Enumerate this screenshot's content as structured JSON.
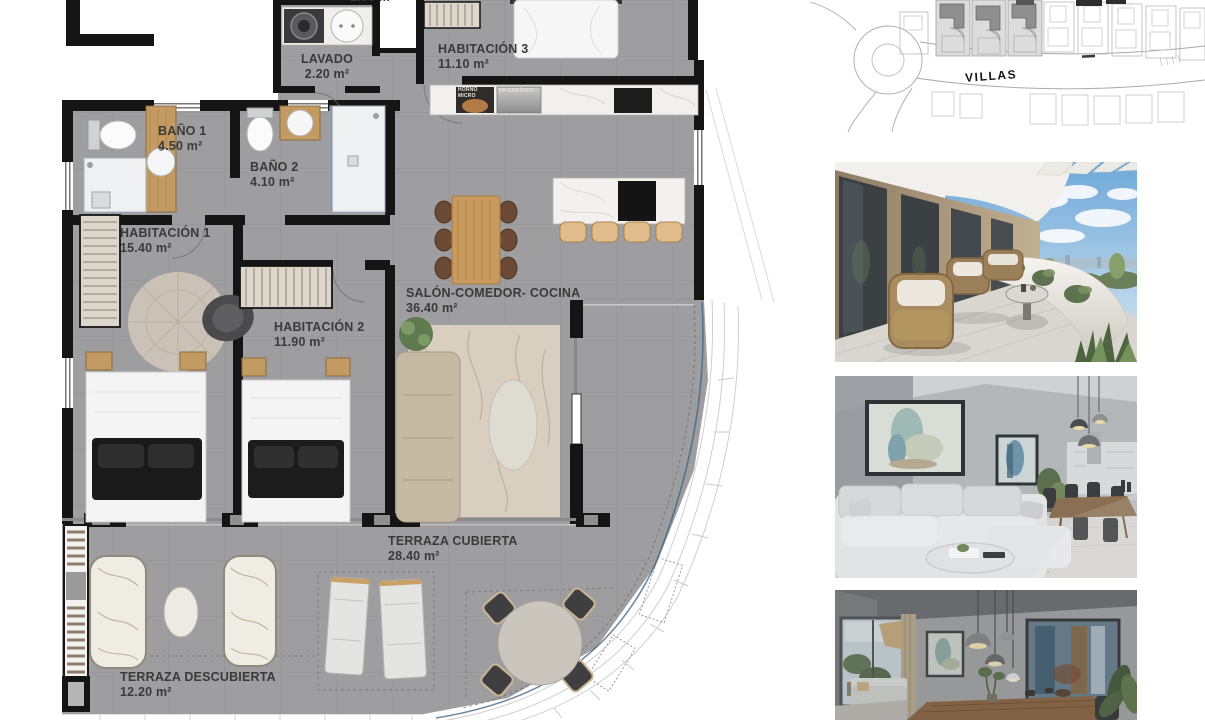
{
  "floor_plan": {
    "rooms": [
      {
        "id": "lavado",
        "name": "LAVADO",
        "area": "2.20 m²"
      },
      {
        "id": "habitacion3",
        "name": "HABITACIÓN 3",
        "area": "11.10 m²"
      },
      {
        "id": "bano1",
        "name": "BAÑO 1",
        "area": "4.50 m²"
      },
      {
        "id": "bano2",
        "name": "BAÑO 2",
        "area": "4.10 m²"
      },
      {
        "id": "habitacion1",
        "name": "HABITACIÓN 1",
        "area": "15.40 m²"
      },
      {
        "id": "habitacion2",
        "name": "HABITACIÓN 2",
        "area": "11.90 m²"
      },
      {
        "id": "salon",
        "name": "SALÓN-COMEDOR- COCINA",
        "area": "36.40 m²"
      },
      {
        "id": "terraza_cubierta",
        "name": "TERRAZA CUBIERTA",
        "area": "28.40 m²"
      },
      {
        "id": "terraza_descubierta",
        "name": "TERRAZA DESCUBIERTA",
        "area": "12.20 m²"
      }
    ],
    "appliances": {
      "oven": "HORNO MICRO",
      "fridge": "FRIGORÍFICO"
    },
    "partial_top_label": "2.00 m",
    "colors": {
      "floor": "#9e9ea0",
      "wall": "#151515",
      "wood": "#c39a62",
      "marble": "#f2f0ec"
    }
  },
  "site_plan": {
    "road_label": "VILLAS"
  }
}
